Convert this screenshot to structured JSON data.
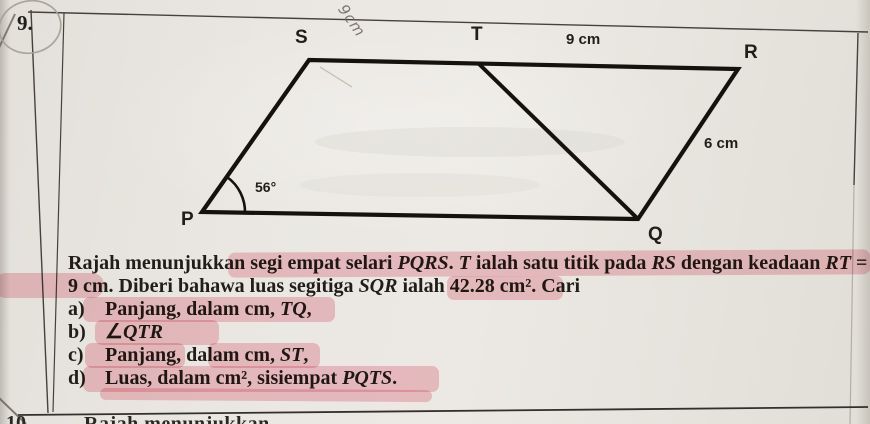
{
  "question": {
    "number": "9.",
    "next_number": "10",
    "next_partial_text": "Rajah menunjukkan"
  },
  "diagram": {
    "vertices": {
      "s": "S",
      "t": "T",
      "r": "R",
      "q": "Q",
      "p": "P"
    },
    "dim_tr": "9 cm",
    "dim_rq": "6 cm",
    "angle_p": "56°",
    "handwritten_note": "9cm"
  },
  "problem": {
    "line1": [
      {
        "t": "Rajah menunjukkan segi empat selari "
      },
      {
        "t": "PQRS",
        "i": true
      },
      {
        "t": ". "
      },
      {
        "t": "T",
        "i": true
      },
      {
        "t": " ialah satu titik pada "
      },
      {
        "t": "RS",
        "i": true
      },
      {
        "t": " dengan keadaan "
      },
      {
        "t": "RT",
        "i": true
      },
      {
        "t": " ="
      }
    ],
    "line2": [
      {
        "t": "9 cm. Diberi bahawa luas segitiga "
      },
      {
        "t": "SQR",
        "i": true
      },
      {
        "t": " ialah 42.28 cm². Cari"
      }
    ],
    "items": [
      {
        "label": "a)",
        "runs": [
          {
            "t": "Panjang, dalam cm, "
          },
          {
            "t": "TQ",
            "i": true
          },
          {
            "t": ","
          }
        ]
      },
      {
        "label": "b)",
        "runs": [
          {
            "t": "∠"
          },
          {
            "t": "QTR",
            "i": true
          }
        ]
      },
      {
        "label": "c)",
        "runs": [
          {
            "t": "Panjang, dalam cm, "
          },
          {
            "t": "ST",
            "i": true
          },
          {
            "t": ","
          }
        ]
      },
      {
        "label": "d)",
        "runs": [
          {
            "t": "Luas, dalam cm², sisiempat "
          },
          {
            "t": "PQTS",
            "i": true
          },
          {
            "t": "."
          }
        ]
      }
    ]
  },
  "colors": {
    "highlight": "#f097a8",
    "paper": "#e9e6e1",
    "ink": "#211d17",
    "diagram_line": "#15120e",
    "table_line": "#45423d"
  }
}
